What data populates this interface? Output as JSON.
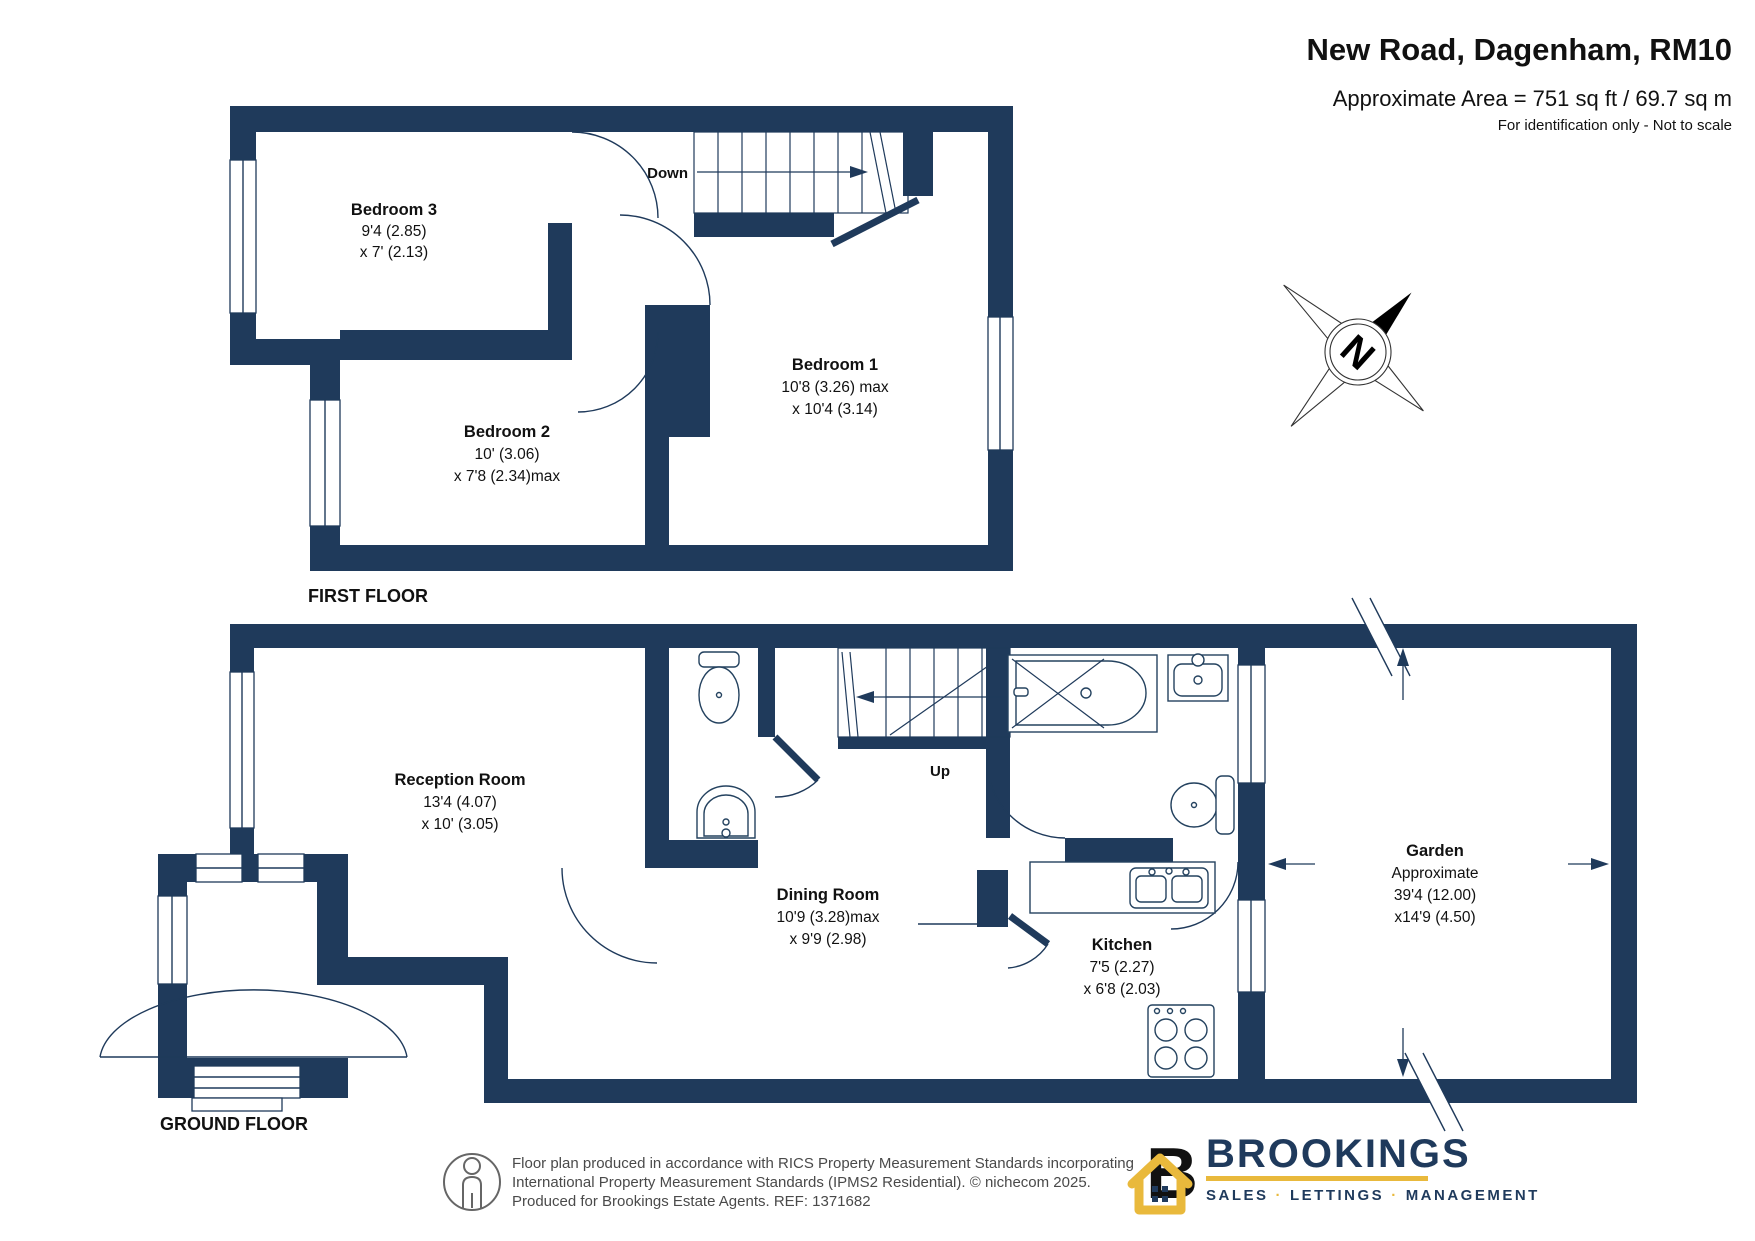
{
  "header": {
    "title": "New Road, Dagenham, RM10",
    "area": "Approximate Area = 751 sq ft / 69.7 sq m",
    "note": "For identification only - Not to scale"
  },
  "floors": {
    "first": "FIRST FLOOR",
    "ground": "GROUND FLOOR"
  },
  "stairs": {
    "down": "Down",
    "up": "Up"
  },
  "rooms": {
    "bedroom3": {
      "name": "Bedroom 3",
      "dim1": "9'4 (2.85)",
      "dim2": "x 7' (2.13)"
    },
    "bedroom2": {
      "name": "Bedroom 2",
      "dim1": "10' (3.06)",
      "dim2": "x 7'8 (2.34)max"
    },
    "bedroom1": {
      "name": "Bedroom 1",
      "dim1": "10'8 (3.26) max",
      "dim2": "x 10'4 (3.14)"
    },
    "reception": {
      "name": "Reception Room",
      "dim1": "13'4 (4.07)",
      "dim2": "x 10' (3.05)"
    },
    "dining": {
      "name": "Dining Room",
      "dim1": "10'9 (3.28)max",
      "dim2": "x 9'9 (2.98)"
    },
    "kitchen": {
      "name": "Kitchen",
      "dim1": "7'5 (2.27)",
      "dim2": "x 6'8 (2.03)"
    },
    "garden": {
      "name": "Garden",
      "line1": "Approximate",
      "line2": "39'4 (12.00)",
      "line3": "x14'9 (4.50)"
    }
  },
  "compass": {
    "north": "N"
  },
  "footer": {
    "line1": "Floor plan produced in accordance with RICS Property Measurement Standards incorporating",
    "line2": "International Property Measurement Standards (IPMS2 Residential).   © nichecom 2025.",
    "line3": "Produced for Brookings Estate Agents.   REF: 1371682"
  },
  "logo": {
    "brand": "BROOKINGS",
    "sales": "SALES",
    "lettings": "LETTINGS",
    "management": "MANAGEMENT",
    "dot": "·"
  },
  "colors": {
    "wall": "#1F3A5B",
    "logo_navy": "#1F3A5C",
    "logo_gold": "#E9B93C"
  }
}
